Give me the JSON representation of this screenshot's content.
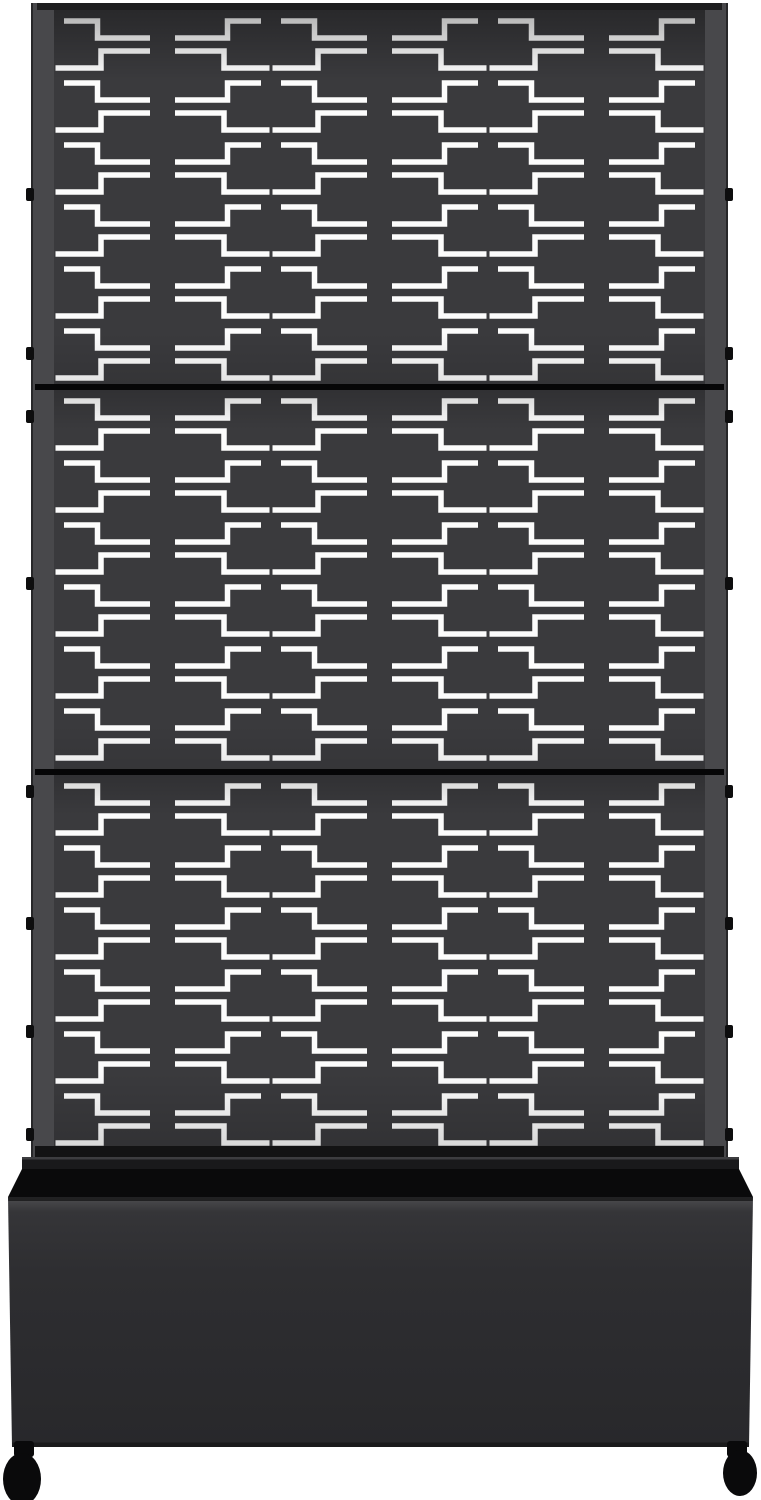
{
  "meta": {
    "type": "product-photo",
    "description": "Black metal outdoor privacy screen with decorative stepped laser-cut pattern, three stacked panels framed by side rails, standing in a matching black planter box with caster wheels on a white background",
    "visible_text": "none"
  },
  "colors": {
    "bg": "#ffffff",
    "panel": "#3a3a3d",
    "cutout": "#fcfcfc",
    "rail": "#48484b",
    "frame_top": "#1e1e1f",
    "frame_bottom": "#131314",
    "divider": "#060607",
    "tab": "#0d0d0e",
    "rim": "#19191b",
    "rim_highlight": "#3d3d40",
    "opening": "#0a0a0b",
    "box_top": "#4d4d50",
    "box_mid": "#2e2e31",
    "box_bottom": "#28282b",
    "box_edge": "#1a1a1b",
    "caster": "#0a0a0b"
  },
  "screen": {
    "panel_count": 3,
    "pattern_columns": 6,
    "pattern_style": "stepped zigzag cutouts in mirrored column pairs",
    "divider_count": 2,
    "mount_tabs_y": [
      188,
      347,
      410,
      577,
      785,
      917,
      1025,
      1128
    ]
  },
  "planter": {
    "shape": "rectangular trough, open top",
    "casters_visible": 2
  }
}
